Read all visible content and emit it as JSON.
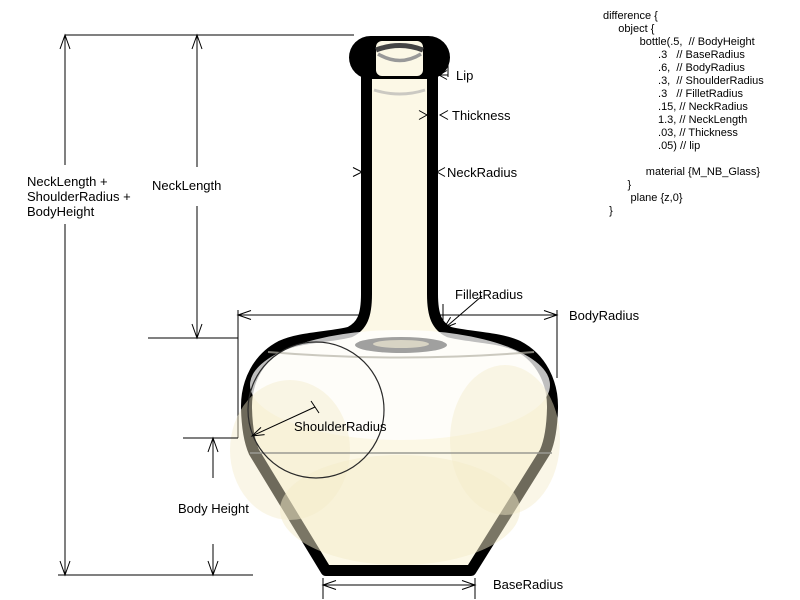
{
  "labels": {
    "composite_height": "NeckLength +\nShoulderRadius +\nBodyHeight",
    "neck_length": "NeckLength",
    "lip": "Lip",
    "thickness": "Thickness",
    "neck_radius": "NeckRadius",
    "fillet_radius": "FilletRadius",
    "body_radius": "BodyRadius",
    "shoulder_radius": "ShoulderRadius",
    "body_height": "Body Height",
    "base_radius": "BaseRadius"
  },
  "code_block": {
    "text": "difference {\n     object {\n            bottle(.5,  // BodyHeight\n                  .3   // BaseRadius\n                  .6,  // BodyRadius\n                  .3,  // ShoulderRadius\n                  .3   // FilletRadius\n                  .15, // NeckRadius\n                  1.3, // NeckLength\n                  .03, // Thickness\n                  .05) // lip\n\n              material {M_NB_Glass}\n        }\n         plane {z,0}\n  }"
  },
  "colors": {
    "ink": "#000000",
    "glass": "#fcf8e6",
    "shade": "#8f8f8f",
    "faint": "#f3ecc9"
  }
}
